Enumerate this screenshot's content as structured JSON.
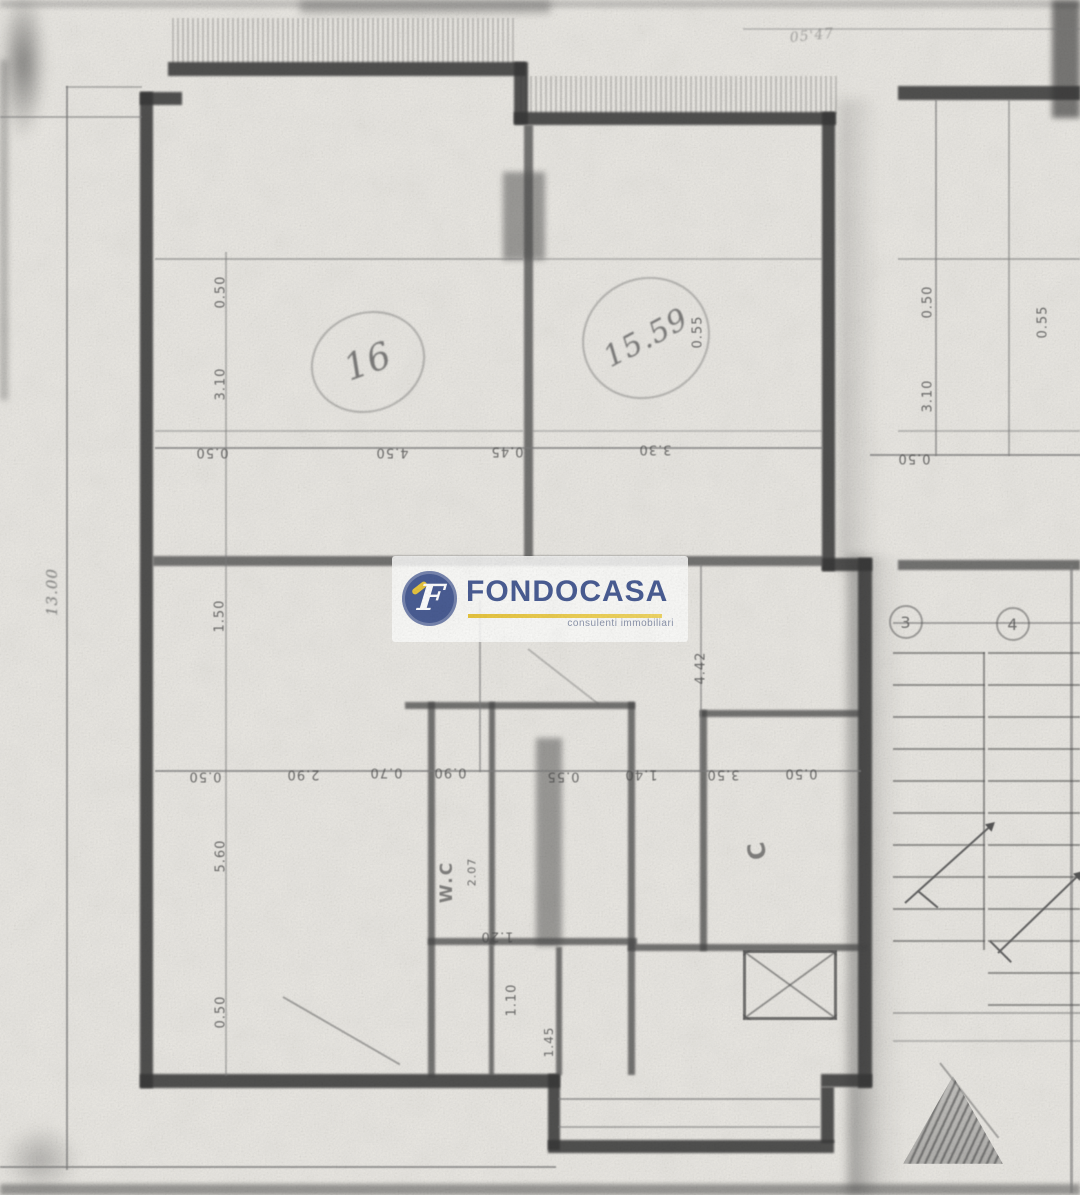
{
  "document": {
    "kind": "scanned floor plan",
    "paper_color": "#e9e7e2",
    "ink_color": "#3a3a3a"
  },
  "logo": {
    "name": "FONDOCASA",
    "tagline": "consulenti immobiliari",
    "brand_blue": "#4a5d94",
    "brand_yellow": "#e8c53e"
  },
  "annotations": {
    "items": [
      {
        "text": "0.50",
        "x": 221,
        "y": 292,
        "rot": -90
      },
      {
        "text": "3.10",
        "x": 221,
        "y": 384,
        "rot": -90
      },
      {
        "text": "0.50",
        "x": 212,
        "y": 452,
        "rot": 180
      },
      {
        "text": "4.50",
        "x": 392,
        "y": 452,
        "rot": 180
      },
      {
        "text": "0.45",
        "x": 507,
        "y": 451,
        "rot": 180
      },
      {
        "text": "3.30",
        "x": 655,
        "y": 449,
        "rot": 180
      },
      {
        "text": "0.55",
        "x": 698,
        "y": 332,
        "rot": -90
      },
      {
        "text": "13.00",
        "x": 52,
        "y": 592,
        "rot": -90,
        "size": 15,
        "kind": "hand"
      },
      {
        "text": "1.50",
        "x": 220,
        "y": 616,
        "rot": -90
      },
      {
        "text": "4.42",
        "x": 701,
        "y": 668,
        "rot": -90
      },
      {
        "text": "0.50",
        "x": 205,
        "y": 776,
        "rot": 180
      },
      {
        "text": "2.90",
        "x": 303,
        "y": 774,
        "rot": 180
      },
      {
        "text": "0.70",
        "x": 386,
        "y": 772,
        "rot": 180
      },
      {
        "text": "0.90",
        "x": 450,
        "y": 772,
        "rot": 180
      },
      {
        "text": "0.55",
        "x": 563,
        "y": 776,
        "rot": 180
      },
      {
        "text": "1.40",
        "x": 641,
        "y": 774,
        "rot": 180
      },
      {
        "text": "3.50",
        "x": 723,
        "y": 774,
        "rot": 180
      },
      {
        "text": "0.50",
        "x": 801,
        "y": 773,
        "rot": 180
      },
      {
        "text": "5.60",
        "x": 221,
        "y": 856,
        "rot": -90
      },
      {
        "text": "0.50",
        "x": 221,
        "y": 1012,
        "rot": -90
      },
      {
        "text": "2.07",
        "x": 472,
        "y": 872,
        "rot": -90,
        "size": 11
      },
      {
        "text": "1.20",
        "x": 497,
        "y": 936,
        "rot": 180
      },
      {
        "text": "1.10",
        "x": 512,
        "y": 1000,
        "rot": -90
      },
      {
        "text": "1.45",
        "x": 549,
        "y": 1042,
        "rot": -90,
        "size": 12
      },
      {
        "text": "0.50",
        "x": 928,
        "y": 302,
        "rot": -90
      },
      {
        "text": "3.10",
        "x": 928,
        "y": 396,
        "rot": -90
      },
      {
        "text": "0.50",
        "x": 914,
        "y": 458,
        "rot": 180
      },
      {
        "text": "0.55",
        "x": 1043,
        "y": 322,
        "rot": -90
      },
      {
        "text": "W.C",
        "x": 447,
        "y": 882,
        "rot": -90,
        "size": 17,
        "kind": "room"
      },
      {
        "text": "C",
        "x": 757,
        "y": 850,
        "rot": -100,
        "size": 24,
        "kind": "room"
      },
      {
        "text": "16",
        "x": 368,
        "y": 362,
        "rot": -20,
        "size": 36,
        "kind": "hand",
        "w": 112,
        "h": 96,
        "circled": true
      },
      {
        "text": "15.59",
        "x": 646,
        "y": 338,
        "rot": -28,
        "size": 30,
        "kind": "hand",
        "w": 126,
        "h": 116,
        "circled": true
      },
      {
        "text": "05'47",
        "x": 812,
        "y": 36,
        "rot": -6,
        "size": 14,
        "kind": "hand",
        "opacity": 0.5
      },
      {
        "text": "3",
        "x": 906,
        "y": 622,
        "kind": "grid"
      },
      {
        "text": "4",
        "x": 1013,
        "y": 624,
        "kind": "grid"
      }
    ]
  }
}
